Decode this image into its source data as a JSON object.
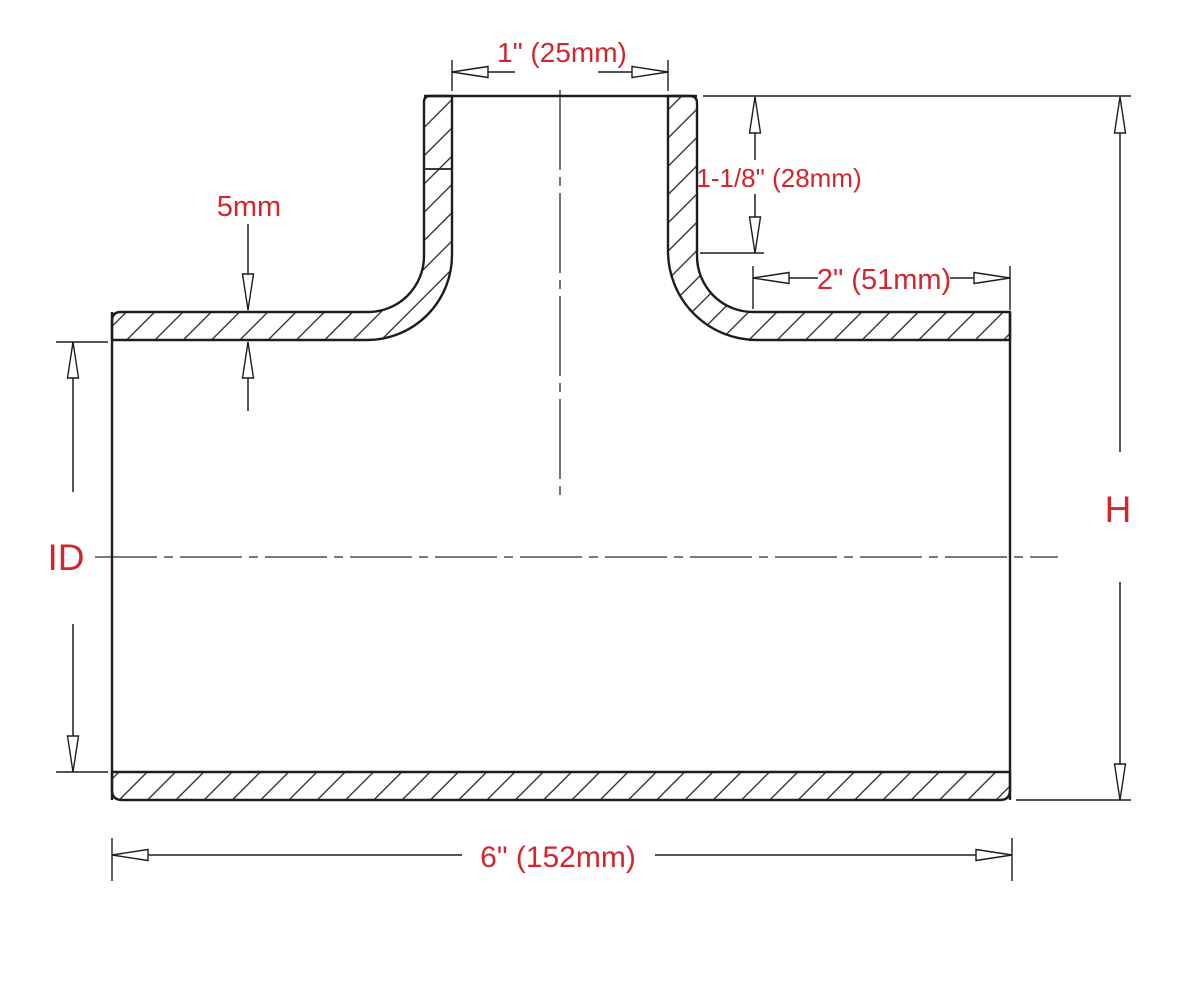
{
  "page": {
    "background": "#ffffff"
  },
  "drawing": {
    "title": "T-coupler hose cross-section dimension drawing",
    "line_color": "#1d1d1f",
    "label_color": "#d2262e",
    "labels": {
      "branch_width": "1\" (25mm)",
      "branch_depth": "1-1/8\" (28mm)",
      "right_shoulder": "2\" (51mm)",
      "wall_thickness": "5mm",
      "inner_diameter": "ID",
      "height": "H",
      "overall_length": "6\" (152mm)"
    }
  }
}
